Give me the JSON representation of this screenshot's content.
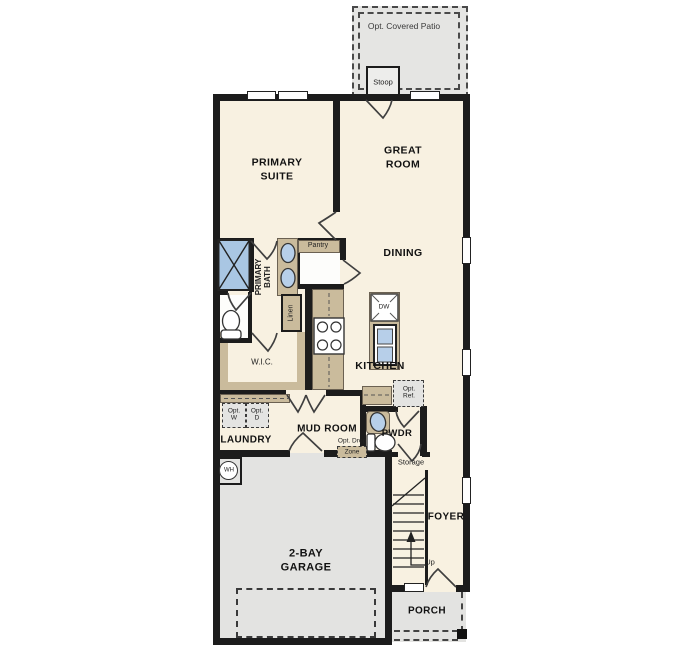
{
  "title": "First Floor Plan",
  "colors": {
    "wall": "#1c1c1c",
    "floor": "#f8f1e1",
    "garage_floor": "#e3e3e1",
    "patio_floor": "#e5e5e3",
    "counter": "#cabb9c",
    "fixture_blue": "#a9c6e3",
    "sink_blue": "#b7cfe9"
  },
  "labels": {
    "opt_covered_patio": "Opt. Covered Patio",
    "stoop": "Stoop",
    "primary_suite": "PRIMARY\nSUITE",
    "great_room": "GREAT\nROOM",
    "dining": "DINING",
    "primary_bath": "PRIMARY\nBATH",
    "pantry": "Pantry",
    "linen": "Linen",
    "wic": "W.I.C.",
    "kitchen": "KITCHEN",
    "dishwasher": "DW",
    "opt_washer": "Opt.\nW",
    "opt_dryer": "Opt.\nD",
    "laundry": "LAUNDRY",
    "mud_room": "MUD ROOM",
    "opt_drop_line1": "Opt. Drop",
    "opt_drop_line2": "Zone",
    "opt_ref": "Opt.\nRef.",
    "pwdr": "PWDR",
    "storage": "Storage",
    "foyer": "FOYER",
    "up": "Up",
    "garage": "2-BAY\nGARAGE",
    "porch": "PORCH",
    "water_heater": "WH"
  }
}
